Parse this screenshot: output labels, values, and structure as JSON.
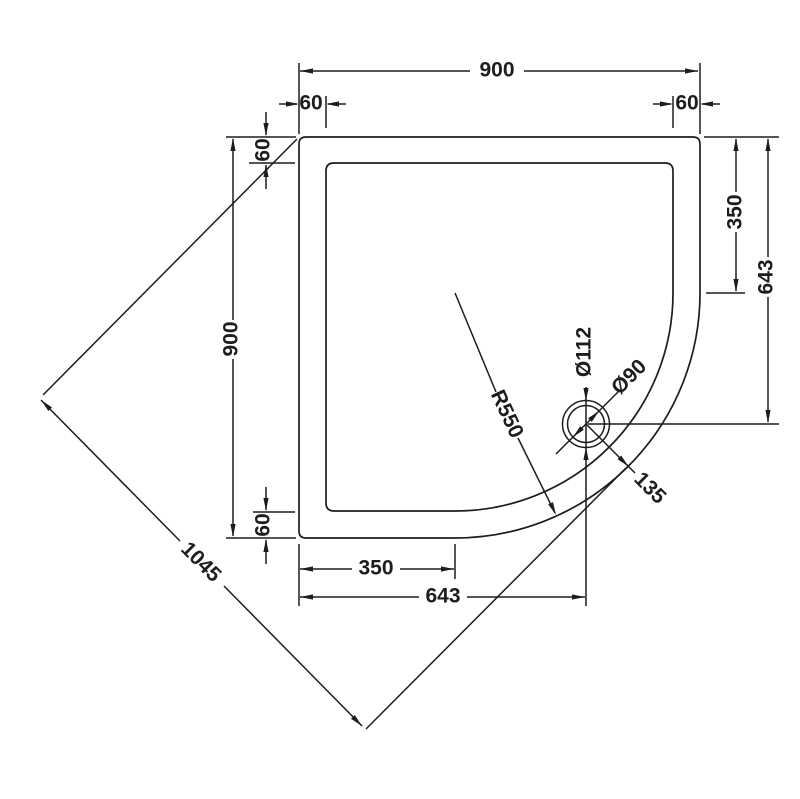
{
  "drawing": {
    "subject": "quadrant-shower-tray-plan-technical-drawing",
    "background": "#ffffff",
    "line_color": "#1d1d1b",
    "labels": {
      "top_width": "900",
      "top_offset_left": "60",
      "top_offset_right": "60",
      "left_height": "900",
      "left_offset_top": "60",
      "left_offset_bottom": "60",
      "right_straight_edge": "350",
      "right_waste_distance": "643",
      "bottom_straight_edge": "350",
      "bottom_waste_distance": "643",
      "diagonal_width": "1045",
      "corner_radius": "R550",
      "waste_outer_diameter": "Ø112",
      "waste_inner_diameter": "Ø90",
      "waste_edge_distance": "135"
    }
  }
}
